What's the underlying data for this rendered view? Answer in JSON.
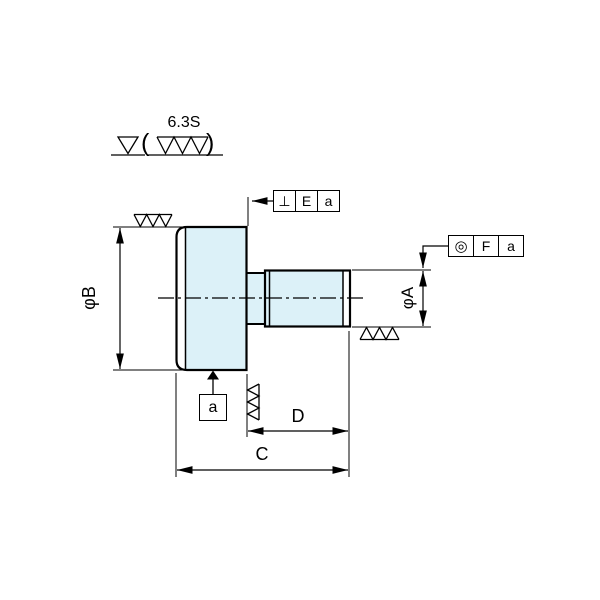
{
  "colors": {
    "line": "#000000",
    "part_fill": "#dcf1f8",
    "background": "#ffffff"
  },
  "surface_note": {
    "roughness": "6.3S",
    "paren_open": "(",
    "paren_close": ")"
  },
  "dimensions": {
    "diameter_b": "φB",
    "diameter_a": "φA",
    "length_c": "C",
    "length_d": "D"
  },
  "datum_box": {
    "label": "a"
  },
  "frames": {
    "perpendicularity": {
      "symbol": "⊥",
      "tolerance_label": "E",
      "datum_ref": "a"
    },
    "concentricity": {
      "symbol": "◎",
      "tolerance_label": "F",
      "datum_ref": "a"
    }
  }
}
